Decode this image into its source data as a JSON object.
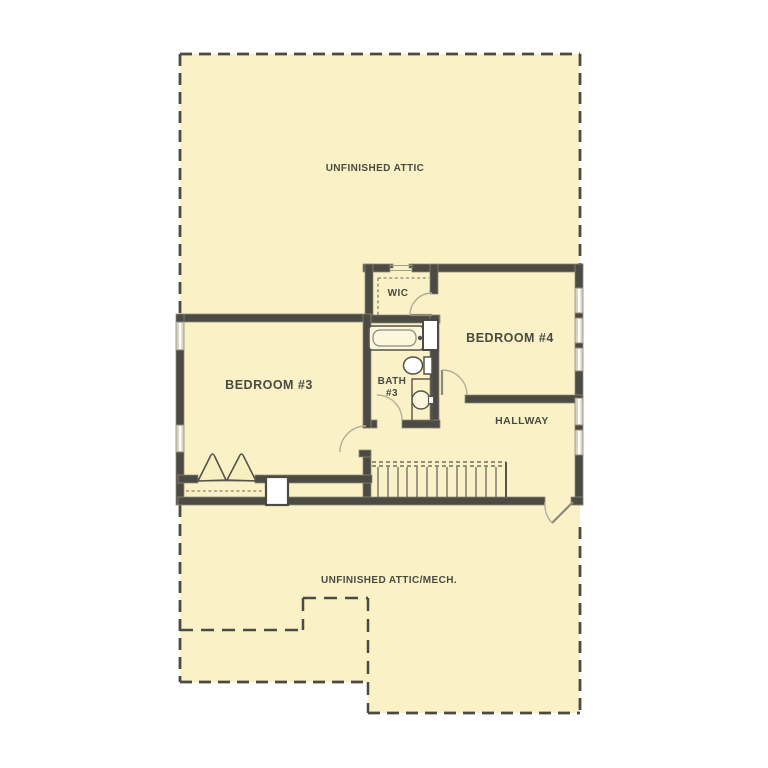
{
  "plan": {
    "labels": {
      "unfinished_attic": "UNFINISHED ATTIC",
      "bedroom3": "BEDROOM #3",
      "wic": "WIC",
      "bath3": {
        "line1": "BATH",
        "line2": "#3"
      },
      "bedroom4": "BEDROOM #4",
      "hallway": "HALLWAY",
      "unfinished_attic_mech": "UNFINISHED ATTIC/MECH."
    },
    "colors": {
      "background": "#FFFFFF",
      "floor": "#FAF2C6",
      "wall": "#4C4B43",
      "window": "#D8D4C3",
      "door_arc": "#B3AE9B",
      "dashed_boundary": "#4C4B43",
      "text": "#4B4A42"
    }
  }
}
